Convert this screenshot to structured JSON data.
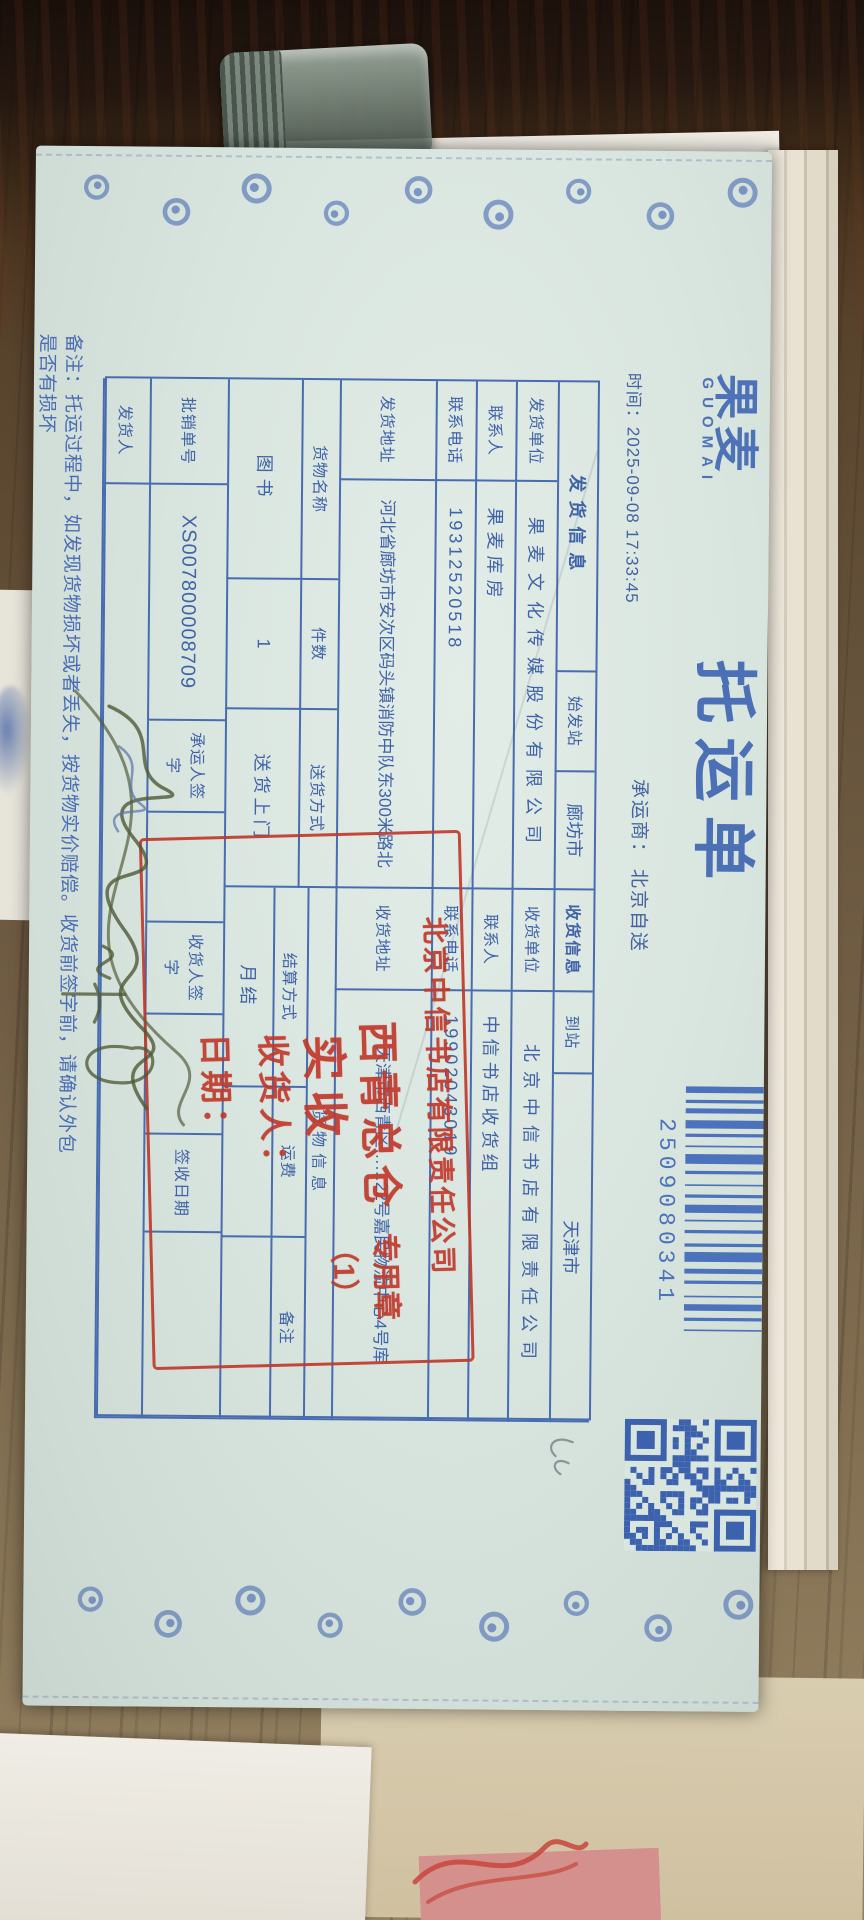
{
  "header": {
    "brand": "果麦",
    "brand_en": "GUOMAI",
    "title": "托运单",
    "time_label": "时间：",
    "time_value": "2025-09-08 17:33:45",
    "carrier_label": "承运商：",
    "carrier_value": "北京自送",
    "barcode_number": "2509080341"
  },
  "shipper": {
    "section": "发货信息",
    "origin_label": "始发站",
    "origin": "廊坊市",
    "unit_label": "发货单位",
    "unit": "果麦文化传媒股份有限公司",
    "contact_label": "联系人",
    "contact": "果麦库房",
    "phone_label": "联系电话",
    "phone": "19312520518",
    "addr_label": "发货地址",
    "addr": "河北省廊坊市安次区码头镇消防中队东300米路北"
  },
  "receiver": {
    "section": "收货信息",
    "dest_label": "到站",
    "dest": "天津市",
    "unit_label": "收货单位",
    "unit": "北京中信书店有限责任公司",
    "contact_label": "联系人",
    "contact": "中信书店收货组",
    "phone_label": "联系电话",
    "phone": "19902043019",
    "addr_label": "收货地址",
    "addr": "天津市西青区……22号嘉民物流中心4号库"
  },
  "goods": {
    "section": "货物信息",
    "name_label": "货物名称",
    "name": "图书",
    "pieces_label": "件数",
    "pieces": "1",
    "delivery_label": "送货方式",
    "delivery": "送货上门",
    "settle_label": "结算方式",
    "settle": "月结",
    "freight_label": "运费",
    "freight": "",
    "remark_label": "备注",
    "remark": ""
  },
  "footer": {
    "batch_label": "批销单号",
    "batch": "XS007800008709",
    "carrier_sign_label": "承运人签字",
    "receiver_sign_label": "收货人签字",
    "sign_date_label": "签收日期",
    "shipper_sign_label": "发货人"
  },
  "stamp": {
    "company": "北京中信书店有限责任公司",
    "warehouse": "西青总仓",
    "seal": "专用章（1）",
    "received": "实收",
    "receiver_label": "收货人：",
    "date_label": "日期："
  },
  "note": {
    "line1": "备注：托运过程中，如发现货物损坏或者丢失，按货物实价赔偿。收货前签字前，请确认外包",
    "line2": "是否有损坏"
  }
}
